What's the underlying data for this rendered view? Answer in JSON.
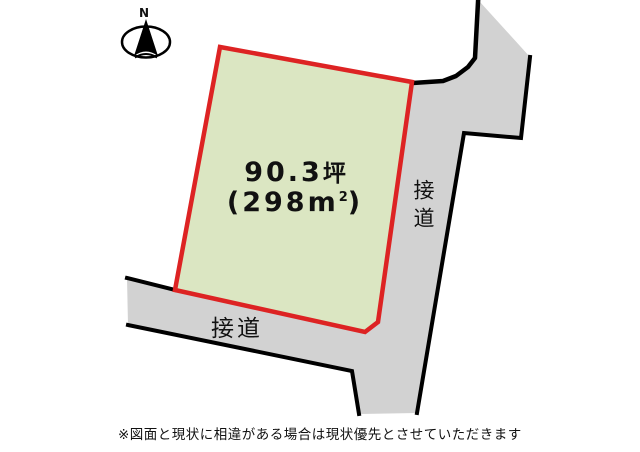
{
  "compass": {
    "north_label": "N"
  },
  "parcel": {
    "area_tsubo": "90.3",
    "tsubo_unit": "坪",
    "area_sqm_open": "(298m",
    "area_sqm_sup": "2",
    "area_sqm_close": ")"
  },
  "roads": {
    "right_label": "接道",
    "bottom_label": "接道"
  },
  "disclaimer": "※図面と現状に相違がある場合は現状優先とさせていただきます",
  "colors": {
    "parcel_fill": "#dbe6c2",
    "parcel_border": "#dd2323",
    "road_fill": "#d2d2d2",
    "line_black": "#000000",
    "compass_fill": "#ffffff"
  }
}
